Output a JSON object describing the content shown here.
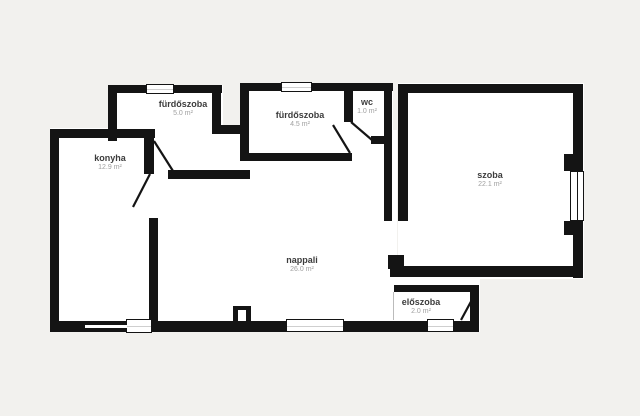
{
  "plan": {
    "title": "floor-plan",
    "colors": {
      "background": "#f2f1ee",
      "wall": "#141414",
      "room_fill": "#ffffff",
      "room_name_text": "#3c3c3c",
      "room_area_text": "#9f9f9f"
    },
    "rooms": [
      {
        "id": "furdoszoba-1",
        "name": "fürdőszoba",
        "area": "5.0 m²"
      },
      {
        "id": "konyha",
        "name": "konyha",
        "area": "12.9 m²"
      },
      {
        "id": "furdoszoba-2",
        "name": "fürdőszoba",
        "area": "4.5 m²"
      },
      {
        "id": "wc",
        "name": "wc",
        "area": "1.0 m²"
      },
      {
        "id": "szoba",
        "name": "szoba",
        "area": "22.1 m²"
      },
      {
        "id": "nappali",
        "name": "nappali",
        "area": "26.0 m²"
      },
      {
        "id": "eloszoba",
        "name": "előszoba",
        "area": "2.0 m²"
      }
    ]
  }
}
